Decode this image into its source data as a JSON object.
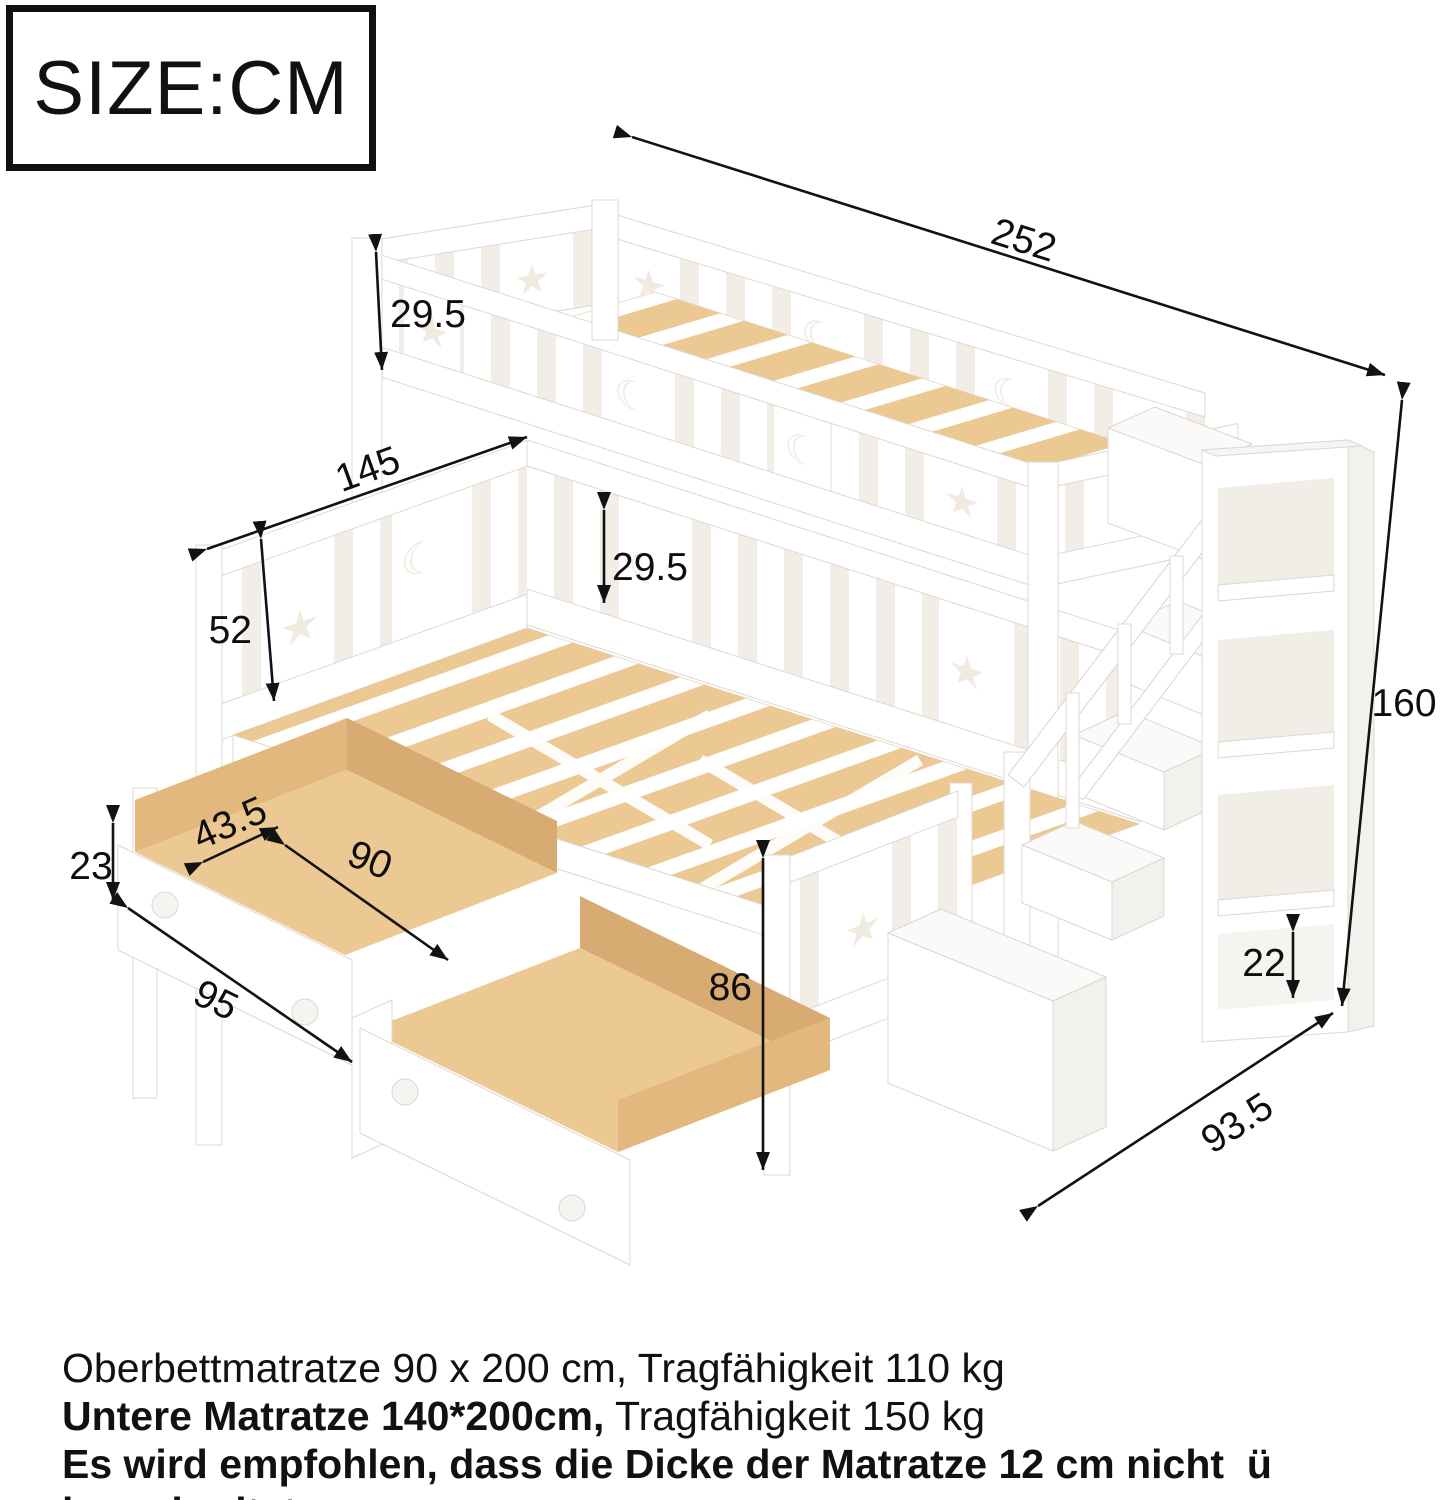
{
  "size_label": "SIZE:CM",
  "dimensions": {
    "length_top": "252",
    "height_total": "160",
    "upper_rail_height": "29.5",
    "lower_width": "145",
    "lower_headboard_height": "52",
    "lower_rail_height": "29.5",
    "under_bed_height": "86",
    "drawer_height": "23",
    "drawer_inner_width": "43.5",
    "drawer_inner_length": "90",
    "drawer_length": "95",
    "bottom_shelf_height": "22",
    "stairs_depth": "93.5"
  },
  "notes": {
    "line1": "Oberbettmatratze 90 x 200 cm, Tragfähigkeit 110 kg",
    "line2_bold": "Untere Matratze 140*200cm,",
    "line2_rest": " Tragfähigkeit 150 kg",
    "line3": "Es wird empfohlen, dass die Dicke der Matratze 12 cm nicht  ü berschreitet"
  },
  "colors": {
    "wood": "#ecc893",
    "wood_dark": "#d8ab72",
    "wood_mid": "#e2b87f",
    "white_outline": "#dcd7d0",
    "rail_gap": "#f2eee7",
    "cutout": "#f0eae1",
    "dimension_line": "#121212"
  }
}
